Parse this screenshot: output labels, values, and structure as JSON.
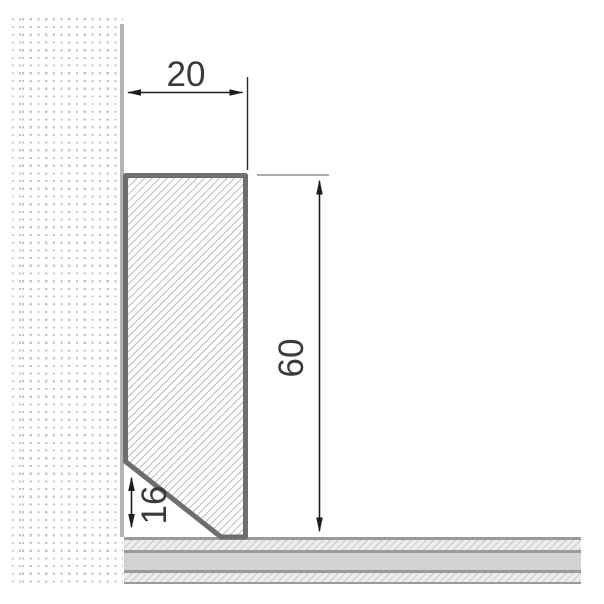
{
  "drawing": {
    "dimensions": {
      "width_label": "20",
      "height_label": "60",
      "notch_label": "16"
    },
    "colors": {
      "profile_outline": "#6e6e6e",
      "profile_hatch_line": "#8d8d8d",
      "dimension_line": "#1d1d1d",
      "dimension_text": "#3a3a3a",
      "extension_line_gray": "#8f8f8f",
      "wall_dot": "#c5c5c5",
      "wall_edge_line": "#b4b4b4",
      "floor_separator_line": "#9b9b9b",
      "floor_screed_fill": "#d2d2d2",
      "floor_hatch_background": "#ededed"
    }
  }
}
